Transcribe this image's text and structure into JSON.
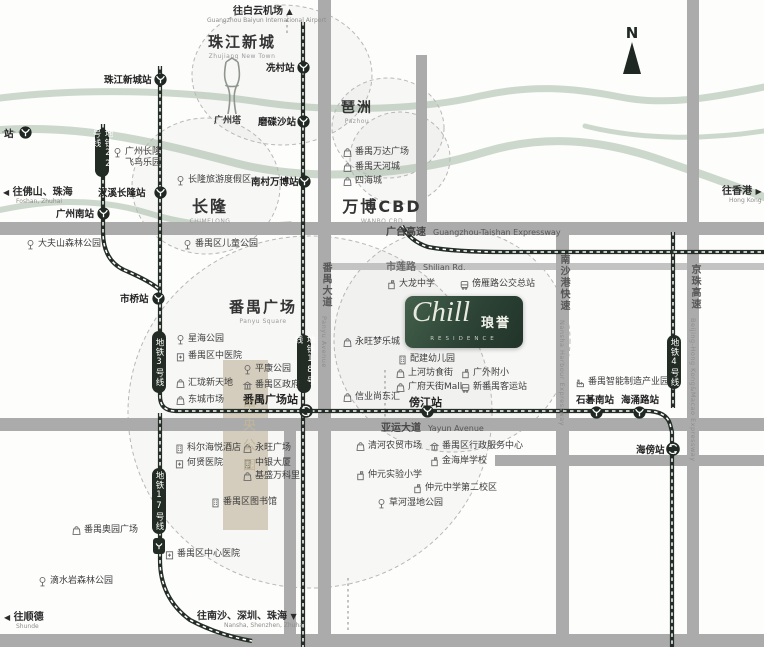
{
  "logo": {
    "script": "Chill",
    "cn": "琅誉",
    "sub": "RESIDENCE"
  },
  "compass": {
    "label": "N"
  },
  "colors": {
    "road": "#ababab",
    "road_light": "#c3c3c3",
    "river": "#ccd8cb",
    "metro": "#242d26",
    "beige": "#d8cfbe",
    "pill": "#222b24",
    "circle": "#b8b8b8",
    "logo_green": "#2f4539"
  },
  "areas": [
    {
      "cn": "珠江新城",
      "en": "Zhujiang New Town",
      "x": 242,
      "y": 31,
      "fs": 15
    },
    {
      "cn": "琶洲",
      "en": "Pazhou",
      "x": 357,
      "y": 97,
      "fs": 14
    },
    {
      "cn": "长隆",
      "en": "CHIMELONG",
      "x": 210,
      "y": 193,
      "fs": 16
    },
    {
      "cn": "万博CBD",
      "en": "WANBO CBD",
      "x": 382,
      "y": 193,
      "fs": 16
    },
    {
      "cn": "番禺广场",
      "en": "Panyu Square",
      "x": 263,
      "y": 296,
      "fs": 15
    }
  ],
  "central_park_label": "中央公园",
  "tower_label": "广州塔",
  "stations": [
    {
      "name": "站",
      "ix": 25,
      "iy": 132,
      "lx": 4,
      "ly": 126,
      "type": "normal"
    },
    {
      "name": "珠江新城站",
      "ix": 160,
      "iy": 79,
      "lx": 104,
      "ly": 72,
      "type": "normal"
    },
    {
      "name": "冼村站",
      "ix": 303,
      "iy": 67,
      "lx": 266,
      "ly": 60,
      "type": "normal"
    },
    {
      "name": "磨碟沙站",
      "ix": 303,
      "iy": 121,
      "lx": 258,
      "ly": 114,
      "type": "normal"
    },
    {
      "name": "汉溪长隆站",
      "ix": 160,
      "iy": 192,
      "lx": 98,
      "ly": 185,
      "type": "normal"
    },
    {
      "name": "广州南站",
      "ix": 103,
      "iy": 213,
      "lx": 56,
      "ly": 206,
      "type": "normal"
    },
    {
      "name": "南村万博站",
      "ix": 304,
      "iy": 181,
      "lx": 251,
      "ly": 174,
      "type": "normal"
    },
    {
      "name": "市桥站",
      "ix": 158,
      "iy": 298,
      "lx": 120,
      "ly": 291,
      "type": "normal"
    },
    {
      "name": "番禺广场站",
      "ix": 305,
      "iy": 410,
      "lx": 243,
      "ly": 391,
      "type": "interchange",
      "big": true
    },
    {
      "name": "傍江站",
      "ix": 427,
      "iy": 411,
      "lx": 409,
      "ly": 394,
      "type": "normal",
      "big": true
    },
    {
      "name": "石碁南站",
      "ix": 596,
      "iy": 412,
      "lx": 576,
      "ly": 392,
      "type": "normal"
    },
    {
      "name": "海涌路站",
      "ix": 639,
      "iy": 412,
      "lx": 621,
      "ly": 392,
      "type": "normal"
    },
    {
      "name": "海傍站",
      "ix": 672,
      "iy": 448,
      "lx": 636,
      "ly": 442,
      "type": "interchange"
    }
  ],
  "metro_pills": [
    {
      "label": "地铁22号线",
      "cx": 102,
      "y": 129,
      "h": 48
    },
    {
      "label": "地铁3号线",
      "cx": 159,
      "y": 331,
      "h": 62
    },
    {
      "label": "地铁18号线",
      "cx": 304,
      "y": 335,
      "h": 58
    },
    {
      "label": "地铁4号线",
      "cx": 674,
      "y": 335,
      "h": 54
    },
    {
      "label": "地铁17号线",
      "cx": 159,
      "y": 468,
      "h": 66,
      "badge": true
    }
  ],
  "pois": [
    {
      "t": "park",
      "n": "广州长隆飞鸟乐园",
      "x": 112,
      "y": 147,
      "lines": [
        "广州长隆",
        "飞鸟乐园"
      ]
    },
    {
      "t": "park",
      "n": "长隆旅游度假区",
      "x": 175,
      "y": 175
    },
    {
      "t": "park",
      "n": "番禺区儿童公园",
      "x": 182,
      "y": 239
    },
    {
      "t": "park",
      "n": "大夫山森林公园",
      "x": 25,
      "y": 239
    },
    {
      "t": "bag",
      "n": "番禺万达广场",
      "x": 342,
      "y": 147
    },
    {
      "t": "bag",
      "n": "番禺天河城",
      "x": 342,
      "y": 162
    },
    {
      "t": "bag",
      "n": "四海城",
      "x": 342,
      "y": 176
    },
    {
      "t": "park",
      "n": "星海公园",
      "x": 175,
      "y": 334
    },
    {
      "t": "hospital",
      "n": "番禺区中医院",
      "x": 175,
      "y": 351
    },
    {
      "t": "bag",
      "n": "汇珑新天地",
      "x": 175,
      "y": 378
    },
    {
      "t": "bag",
      "n": "东城市场",
      "x": 175,
      "y": 395
    },
    {
      "t": "park",
      "n": "平康公园",
      "x": 242,
      "y": 364
    },
    {
      "t": "gov",
      "n": "番禺区政府",
      "x": 242,
      "y": 380
    },
    {
      "t": "school",
      "n": "大龙中学",
      "x": 386,
      "y": 279
    },
    {
      "t": "bus",
      "n": "傍雁路公交总站",
      "x": 459,
      "y": 279
    },
    {
      "t": "bag",
      "n": "永旺梦乐城",
      "x": 342,
      "y": 337
    },
    {
      "t": "building",
      "n": "配建幼儿园",
      "x": 397,
      "y": 354
    },
    {
      "t": "bag",
      "n": "上河坊食街",
      "x": 395,
      "y": 368
    },
    {
      "t": "school",
      "n": "广外附小",
      "x": 460,
      "y": 368
    },
    {
      "t": "bag",
      "n": "广府天街Mall",
      "x": 395,
      "y": 382
    },
    {
      "t": "bus",
      "n": "新番禺客运站",
      "x": 460,
      "y": 382
    },
    {
      "t": "bag",
      "n": "信业尚东汇",
      "x": 342,
      "y": 392
    },
    {
      "t": "bag",
      "n": "清河农贸市场",
      "x": 355,
      "y": 441
    },
    {
      "t": "gov",
      "n": "番禺区行政服务中心",
      "x": 429,
      "y": 441
    },
    {
      "t": "school",
      "n": "金海岸学校",
      "x": 429,
      "y": 456
    },
    {
      "t": "school",
      "n": "仲元实验小学",
      "x": 355,
      "y": 470
    },
    {
      "t": "school",
      "n": "仲元中学第二校区",
      "x": 412,
      "y": 483
    },
    {
      "t": "park",
      "n": "草河湿地公园",
      "x": 376,
      "y": 498
    },
    {
      "t": "building",
      "n": "科尔海悦酒店",
      "x": 174,
      "y": 443
    },
    {
      "t": "hospital",
      "n": "何贤医院",
      "x": 174,
      "y": 458
    },
    {
      "t": "bag",
      "n": "永旺广场",
      "x": 242,
      "y": 443
    },
    {
      "t": "building",
      "n": "中银大厦",
      "x": 242,
      "y": 458
    },
    {
      "t": "bag",
      "n": "基盛万科里",
      "x": 242,
      "y": 471
    },
    {
      "t": "building",
      "n": "番禺区图书馆",
      "x": 210,
      "y": 497
    },
    {
      "t": "hospital",
      "n": "番禺区中心医院",
      "x": 164,
      "y": 549
    },
    {
      "t": "bag",
      "n": "番禺奥园广场",
      "x": 71,
      "y": 525
    },
    {
      "t": "park",
      "n": "滴水岩森林公园",
      "x": 37,
      "y": 576
    },
    {
      "t": "factory",
      "n": "番禺智能制造产业园",
      "x": 575,
      "y": 377
    }
  ],
  "road_labels": [
    {
      "cn": "广台高速",
      "en": "Guangzhou-Taishan Expressway",
      "x": 386,
      "y": 223,
      "vertical": false
    },
    {
      "cn": "市莲路",
      "en": "Shilian Rd.",
      "x": 386,
      "y": 258,
      "vertical": false,
      "light": true
    },
    {
      "cn": "亚运大道",
      "en": "Yayun Avenue",
      "x": 381,
      "y": 419,
      "vertical": false
    },
    {
      "cn": "番禺大道",
      "en": "Panyu Avenue",
      "cx": 324,
      "y": 262,
      "vertical": true
    },
    {
      "cn": "南沙港快速",
      "en": "Nansha Harbour Expressway",
      "cx": 562,
      "y": 254,
      "vertical": true
    },
    {
      "cn": "京珠高速",
      "en": "Beijing-Hong Kong&Macao Expressway",
      "cx": 693,
      "y": 264,
      "vertical": true
    }
  ],
  "directions": [
    {
      "text": "往白云机场",
      "en": "Guangzhou Baiyun International Airport",
      "arrow": "▲",
      "pos": "after",
      "x": 233,
      "y": 2,
      "en_dx": -26
    },
    {
      "text": "往佛山、珠海",
      "en": "Foshan, Zhuhai",
      "arrow": "◀",
      "pos": "before",
      "x": 3,
      "y": 183,
      "en_dx": 13
    },
    {
      "text": "往香港",
      "en": "Hong Kong",
      "arrow": "▶",
      "pos": "after",
      "x": 722,
      "y": 182,
      "en_dx": 7
    },
    {
      "text": "往顺德",
      "en": "Shunde",
      "arrow": "◀",
      "pos": "before",
      "x": 4,
      "y": 608,
      "en_dx": 12
    },
    {
      "text": "往南沙、深圳、珠海",
      "en": "Nansha, Shenzhen, Zhuhai",
      "arrow": "▼",
      "pos": "after",
      "x": 197,
      "y": 607,
      "en_dx": 27
    }
  ],
  "features": {
    "rivers": [
      {
        "d": "M0,98 C80,88 180,90 260,102 C340,114 430,108 480,96 C530,85 570,87 620,97 C670,107 725,95 764,87",
        "w": 7
      },
      {
        "d": "M0,130 C90,124 170,146 235,163 C320,185 420,172 485,152 C545,134 600,140 655,158 C705,175 740,188 764,197",
        "w": 8
      },
      {
        "d": "M0,210 C55,198 105,200 148,213 C190,226 235,230 290,224",
        "w": 6
      },
      {
        "d": "M585,126 C640,140 705,140 764,131",
        "w": 5
      }
    ],
    "central_park_block": {
      "x": 223,
      "y": 360,
      "w": 45,
      "h": 170
    },
    "circles": [
      {
        "cx": 282,
        "cy": 75,
        "rx": 90,
        "ry": 70
      },
      {
        "cx": 388,
        "cy": 128,
        "rx": 56,
        "ry": 50
      },
      {
        "cx": 206,
        "cy": 186,
        "rx": 74,
        "ry": 68
      },
      {
        "cx": 400,
        "cy": 158,
        "rx": 50,
        "ry": 46
      },
      {
        "cx": 452,
        "cy": 340,
        "rx": 118,
        "ry": 112
      },
      {
        "cx": 310,
        "cy": 412,
        "rx": 182,
        "ry": 176
      }
    ],
    "roads": [
      {
        "x": 0,
        "y": 222,
        "w": 764,
        "h": 13
      },
      {
        "x": 318,
        "y": 263,
        "w": 446,
        "h": 7,
        "light": true
      },
      {
        "x": 0,
        "y": 418,
        "w": 764,
        "h": 13
      },
      {
        "x": 495,
        "y": 455,
        "w": 269,
        "h": 11
      },
      {
        "x": 0,
        "y": 634,
        "w": 764,
        "h": 13
      },
      {
        "x": 318,
        "y": 0,
        "w": 13,
        "h": 647
      },
      {
        "x": 416,
        "y": 55,
        "w": 11,
        "h": 170
      },
      {
        "x": 687,
        "y": 0,
        "w": 12,
        "h": 647
      },
      {
        "x": 556,
        "y": 222,
        "w": 13,
        "h": 425
      },
      {
        "x": 284,
        "y": 431,
        "w": 12,
        "h": 203
      }
    ],
    "dotted_lines": [
      {
        "x1": 287,
        "y1": 14,
        "x2": 287,
        "y2": 34
      },
      {
        "x1": 385,
        "y1": 370,
        "x2": 385,
        "y2": 432
      },
      {
        "x1": 348,
        "y1": 578,
        "x2": 348,
        "y2": 633
      },
      {
        "x1": 2,
        "y1": 132,
        "x2": 19,
        "y2": 132
      }
    ],
    "metro_lines": [
      {
        "name": "metro-line-3",
        "d": "M160,66 L160,396 Q160,411 176,411 L646,411 Q666,411 670,424 L672,432 L672,647"
      },
      {
        "name": "metro-line-22",
        "d": "M103,124 L103,232 Q103,260 124,270 Q150,281 160,290"
      },
      {
        "name": "metro-line-18",
        "d": "M303,22 L303,647"
      },
      {
        "name": "metro-line-4",
        "d": "M673,232 L673,408"
      },
      {
        "name": "metro-line-17",
        "d": "M160,413 L160,560 Q160,598 190,620 Q218,635 252,641"
      },
      {
        "name": "railway-line",
        "d": "M402,226 Q410,241 428,247 Q455,252 505,252 L764,252"
      }
    ]
  }
}
